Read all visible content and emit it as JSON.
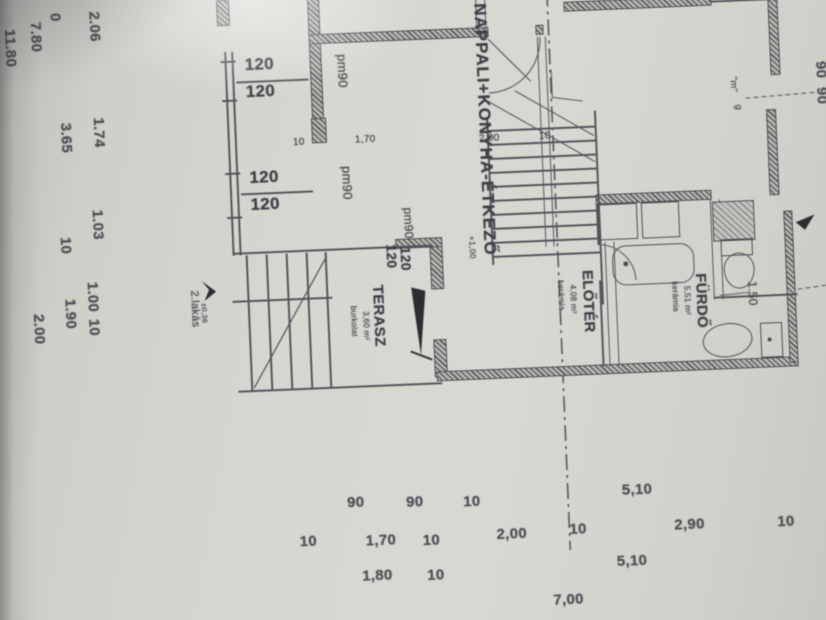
{
  "rooms": {
    "nappali": {
      "name": "NAPPALI+KONYHA-ÉTKEZŐ",
      "elevation": "+1,00"
    },
    "eloter": {
      "name": "ELŐTÉR",
      "finish": "kerámia",
      "area": "4,08 m²"
    },
    "furdo": {
      "name": "FÜRDŐ",
      "finish": "kerámia",
      "area": "5,51 m²"
    },
    "terasz": {
      "name": "TERASZ",
      "finish": "burkolat",
      "area": "3,60 m²"
    },
    "unit": {
      "name": "2.lakás",
      "elevation": "±0,36"
    },
    "wc": {
      "width": "1.50"
    }
  },
  "openings": {
    "windows": [
      "120",
      "120",
      "120",
      "120",
      "120",
      "120"
    ],
    "sills": [
      "pm90",
      "pm90",
      "pm90"
    ]
  },
  "marks": {
    "m": "\"m\"",
    "g": "g",
    "edge": [
      "90",
      "90"
    ]
  },
  "dims": {
    "left": [
      "2.06",
      "0",
      "7.80",
      "11.80",
      "1.74",
      "3.65",
      "1.03",
      "10",
      "1.00",
      "1.90",
      "10",
      "2.00"
    ],
    "inner": [
      "10",
      "1,70",
      "2,00",
      "10"
    ],
    "row1": [
      "90",
      "90",
      "10",
      "5,10"
    ],
    "row2": [
      "10",
      "1,70",
      "10",
      "2,00",
      "10",
      "2,90",
      "10"
    ],
    "row3": [
      "1,80",
      "10",
      "5,10"
    ],
    "row4": [
      "7,00"
    ]
  }
}
